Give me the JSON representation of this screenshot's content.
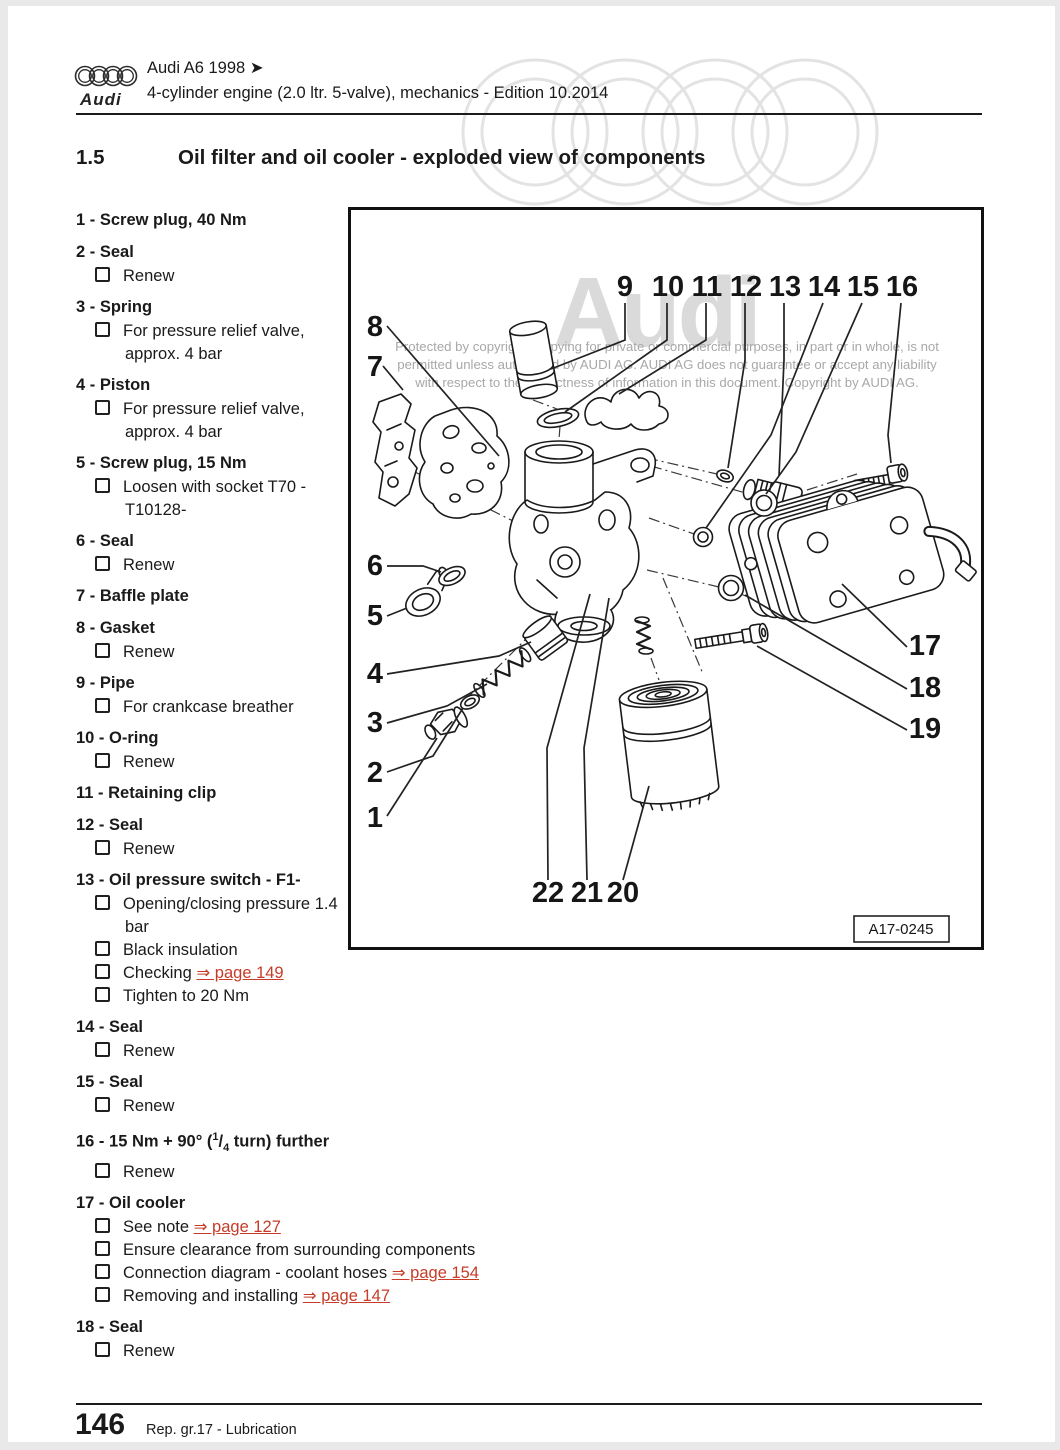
{
  "header": {
    "logo_word": "Audi",
    "model_line": "Audi A6 1998 ➤",
    "edition_line": "4-cylinder engine (2.0 ltr. 5-valve), mechanics - Edition 10.2014"
  },
  "heading": {
    "number": "1.5",
    "title": "Oil filter and oil cooler - exploded view of components"
  },
  "parts": [
    {
      "num": "1",
      "title": "Screw plug, 40 Nm",
      "subs": []
    },
    {
      "num": "2",
      "title": "Seal",
      "subs": [
        {
          "text": "Renew"
        }
      ]
    },
    {
      "num": "3",
      "title": "Spring",
      "subs": [
        {
          "text": "For pressure relief valve, approx. 4 bar"
        }
      ]
    },
    {
      "num": "4",
      "title": "Piston",
      "subs": [
        {
          "text": "For pressure relief valve, approx. 4 bar"
        }
      ]
    },
    {
      "num": "5",
      "title": "Screw plug, 15 Nm",
      "subs": [
        {
          "text": "Loosen with socket T70 - T10128-"
        }
      ]
    },
    {
      "num": "6",
      "title": "Seal",
      "subs": [
        {
          "text": "Renew"
        }
      ]
    },
    {
      "num": "7",
      "title": "Baffle plate",
      "subs": []
    },
    {
      "num": "8",
      "title": "Gasket",
      "subs": [
        {
          "text": "Renew"
        }
      ]
    },
    {
      "num": "9",
      "title": "Pipe",
      "subs": [
        {
          "text": "For crankcase breather"
        }
      ]
    },
    {
      "num": "10",
      "title": "O-ring",
      "subs": [
        {
          "text": "Renew"
        }
      ]
    },
    {
      "num": "11",
      "title": "Retaining clip",
      "subs": []
    },
    {
      "num": "12",
      "title": "Seal",
      "subs": [
        {
          "text": "Renew"
        }
      ]
    },
    {
      "num": "13",
      "title": "Oil pressure switch - F1-",
      "subs": [
        {
          "text": "Opening/closing pressure 1.4 bar"
        },
        {
          "text": "Black insulation"
        },
        {
          "text": "Checking",
          "link": "⇒ page 149"
        },
        {
          "text": "Tighten to 20 Nm"
        }
      ]
    },
    {
      "num": "14",
      "title": "Seal",
      "subs": [
        {
          "text": "Renew"
        }
      ]
    },
    {
      "num": "15",
      "title": "Seal",
      "subs": [
        {
          "text": "Renew"
        }
      ]
    },
    {
      "num": "16",
      "title": "15 Nm + 90° (1/4 turn) further",
      "frac": {
        "pre": "15 Nm + 90° (",
        "sup": "1",
        "slash": "/",
        "sub": "4",
        "post": " turn) further"
      },
      "subs": [
        {
          "text": "Renew"
        }
      ]
    },
    {
      "num": "17",
      "title": "Oil cooler",
      "subs": [
        {
          "text": "See note",
          "link": "⇒ page 127"
        },
        {
          "text": "Ensure clearance from surrounding components"
        },
        {
          "text": "Connection diagram - coolant hoses",
          "link": "⇒ page 154"
        },
        {
          "text": "Removing and installing",
          "link": "⇒ page 147"
        }
      ]
    },
    {
      "num": "18",
      "title": "Seal",
      "subs": [
        {
          "text": "Renew"
        }
      ]
    }
  ],
  "diagram": {
    "image_code": "A17-0245",
    "watermark_word": "Audi",
    "copyright_lines": [
      "Protected by copyright. Copying for private or commercial purposes, in part or in whole, is not",
      "permitted unless authorised by AUDI AG. AUDI AG does not guarantee or accept any liability",
      "with respect to the correctness of information in this document. Copyright by AUDI AG."
    ],
    "callouts": [
      {
        "label": "9",
        "x": 274,
        "y": 86,
        "line": [
          [
            274,
            93
          ],
          [
            274,
            130
          ],
          [
            200,
            159
          ]
        ]
      },
      {
        "label": "10",
        "x": 317,
        "y": 86,
        "line": [
          [
            316,
            93
          ],
          [
            316,
            130
          ],
          [
            214,
            202
          ]
        ]
      },
      {
        "label": "11",
        "x": 356,
        "y": 86,
        "line": [
          [
            355,
            93
          ],
          [
            355,
            130
          ],
          [
            268,
            184
          ]
        ]
      },
      {
        "label": "12",
        "x": 395,
        "y": 86,
        "line": [
          [
            394,
            93
          ],
          [
            394,
            150
          ],
          [
            377,
            258
          ]
        ]
      },
      {
        "label": "13",
        "x": 434,
        "y": 86,
        "line": [
          [
            433,
            93
          ],
          [
            433,
            150
          ],
          [
            428,
            266
          ]
        ]
      },
      {
        "label": "14",
        "x": 473,
        "y": 86,
        "line": [
          [
            472,
            93
          ],
          [
            420,
            225
          ],
          [
            355,
            318
          ]
        ]
      },
      {
        "label": "15",
        "x": 512,
        "y": 86,
        "line": [
          [
            511,
            93
          ],
          [
            445,
            242
          ],
          [
            415,
            284
          ]
        ]
      },
      {
        "label": "16",
        "x": 551,
        "y": 86,
        "line": [
          [
            550,
            93
          ],
          [
            537,
            225
          ],
          [
            540,
            253
          ]
        ]
      },
      {
        "label": "8",
        "x": 24,
        "y": 126,
        "line": [
          [
            36,
            116
          ],
          [
            148,
            246
          ]
        ]
      },
      {
        "label": "7",
        "x": 24,
        "y": 166,
        "line": [
          [
            32,
            156
          ],
          [
            52,
            180
          ]
        ]
      },
      {
        "label": "6",
        "x": 24,
        "y": 365,
        "line": [
          [
            36,
            356
          ],
          [
            72,
            356
          ],
          [
            90,
            362
          ]
        ]
      },
      {
        "label": "5",
        "x": 24,
        "y": 415,
        "line": [
          [
            36,
            406
          ],
          [
            56,
            398
          ]
        ]
      },
      {
        "label": "4",
        "x": 24,
        "y": 473,
        "line": [
          [
            36,
            464
          ],
          [
            148,
            446
          ],
          [
            180,
            432
          ]
        ]
      },
      {
        "label": "3",
        "x": 24,
        "y": 522,
        "line": [
          [
            36,
            513
          ],
          [
            96,
            496
          ],
          [
            136,
            474
          ]
        ]
      },
      {
        "label": "2",
        "x": 24,
        "y": 572,
        "line": [
          [
            36,
            562
          ],
          [
            82,
            546
          ],
          [
            112,
            498
          ]
        ]
      },
      {
        "label": "1",
        "x": 24,
        "y": 617,
        "line": [
          [
            36,
            606
          ],
          [
            86,
            528
          ]
        ]
      },
      {
        "label": "17",
        "x": 574,
        "y": 445,
        "line": [
          [
            556,
            437
          ],
          [
            491,
            374
          ]
        ]
      },
      {
        "label": "18",
        "x": 574,
        "y": 487,
        "line": [
          [
            556,
            479
          ],
          [
            394,
            385
          ]
        ]
      },
      {
        "label": "19",
        "x": 574,
        "y": 528,
        "line": [
          [
            556,
            520
          ],
          [
            406,
            436
          ]
        ]
      },
      {
        "label": "22",
        "x": 197,
        "y": 692,
        "line": [
          [
            197,
            670
          ],
          [
            196,
            538
          ],
          [
            239,
            384
          ]
        ]
      },
      {
        "label": "21",
        "x": 236,
        "y": 692,
        "line": [
          [
            236,
            670
          ],
          [
            233,
            538
          ],
          [
            258,
            388
          ]
        ]
      },
      {
        "label": "20",
        "x": 272,
        "y": 692,
        "line": [
          [
            272,
            670
          ],
          [
            298,
            576
          ]
        ]
      }
    ]
  },
  "footer": {
    "page_number": "146",
    "section": "Rep. gr.17 - Lubrication"
  },
  "colors": {
    "link_red": "#c63c28",
    "rings_gray": "#e3e3e3",
    "watermark_gray": "#a8a8a8",
    "audi_watermark": "#dadada"
  }
}
